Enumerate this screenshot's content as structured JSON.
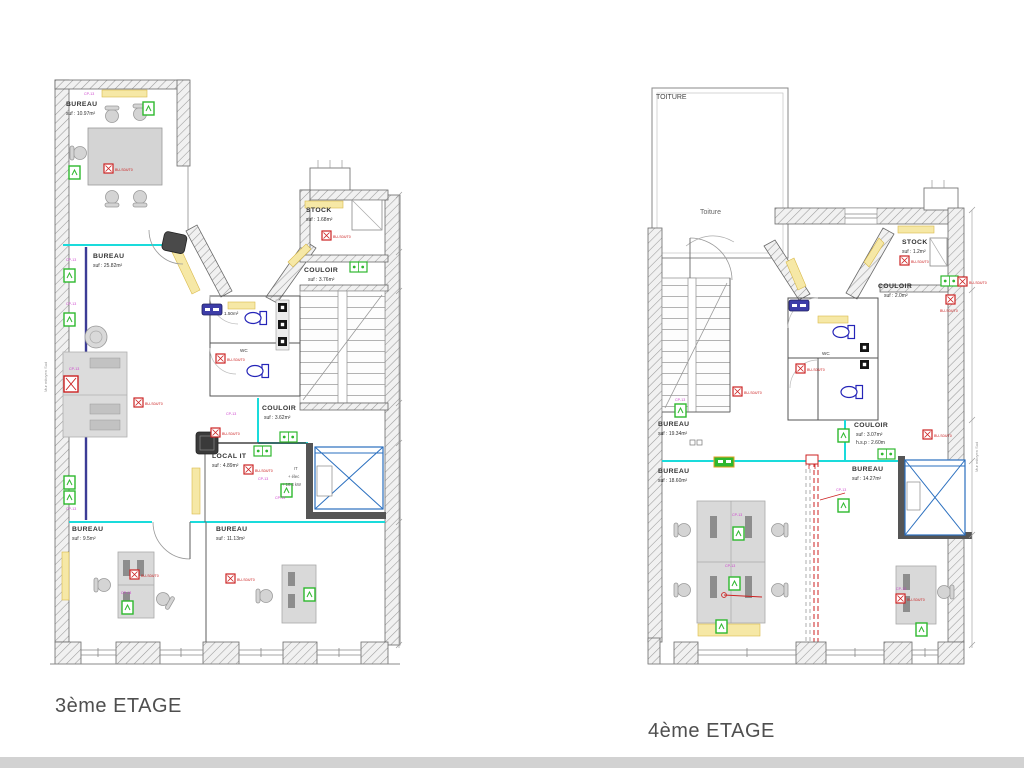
{
  "plans": {
    "left": {
      "title": "3ème ETAGE",
      "rooms": {
        "bureau_top": {
          "name": "BUREAU",
          "area": "suf :    10.97m²"
        },
        "bureau_main": {
          "name": "BUREAU",
          "area": "suf :    25.82m²"
        },
        "wc_top": {
          "name": "WC",
          "area": "1.50m²"
        },
        "wc_bottom": {
          "name": "WC"
        },
        "stock": {
          "name": "STOCK",
          "area": "suf :  1.68m²"
        },
        "couloir_top": {
          "name": "COULOIR",
          "area": "suf :  3.76m²"
        },
        "couloir_mid": {
          "name": "COULOIR",
          "area": "suf :  3.62m²"
        },
        "local_it": {
          "name": "LOCAL IT",
          "area": "suf :  4.89m²"
        },
        "bureau_bottom_left": {
          "name": "BUREAU",
          "area": "suf :  9.5m²"
        },
        "bureau_bottom_mid": {
          "name": "BUREAU",
          "area": "suf :  11.13m²"
        }
      },
      "it_notes": {
        "l1": "IT",
        "l2": "+ élec",
        "l3": "+ 10.3 kW"
      },
      "side_note": "Mur mitoyen Sud"
    },
    "right": {
      "title": "4ème ETAGE",
      "roof_corner": "TOITURE",
      "roof_center": "Toiture",
      "rooms": {
        "stock": {
          "name": "STOCK",
          "area": "suf :  1.2m²"
        },
        "couloir_top": {
          "name": "COULOIR",
          "area": "suf :  2.0m²"
        },
        "wc": {
          "name": "WC"
        },
        "bureau_19": {
          "name": "BUREAU",
          "area": "suf :  19.34m²"
        },
        "bureau_18": {
          "name": "BUREAU",
          "area": "suf :  18.60m²"
        },
        "couloir_mid": {
          "name": "COULOIR",
          "area": "suf :  3.07m²",
          "hsp": "h.s.p :  2.60m"
        },
        "bureau_14": {
          "name": "BUREAU",
          "area": "suf :  14.27m²"
        }
      },
      "side_note": "Mur mitoyen Sud"
    }
  },
  "tags": {
    "red_label": "BU-S04/T0",
    "magenta_label": "CP-13"
  },
  "colors": {
    "cyan_partition": "#1adbdb",
    "red_equipment": "#cc2222",
    "green_safety": "#2eb82e",
    "magenta_tag": "#cc3fcc",
    "yellow_radiator": "#f6e8a6",
    "indigo_line": "#3c3c96",
    "toilet_blue": "#2525b8",
    "elevator_blue": "#2a6fbf",
    "wall_hatch": "#9a9a9a"
  }
}
